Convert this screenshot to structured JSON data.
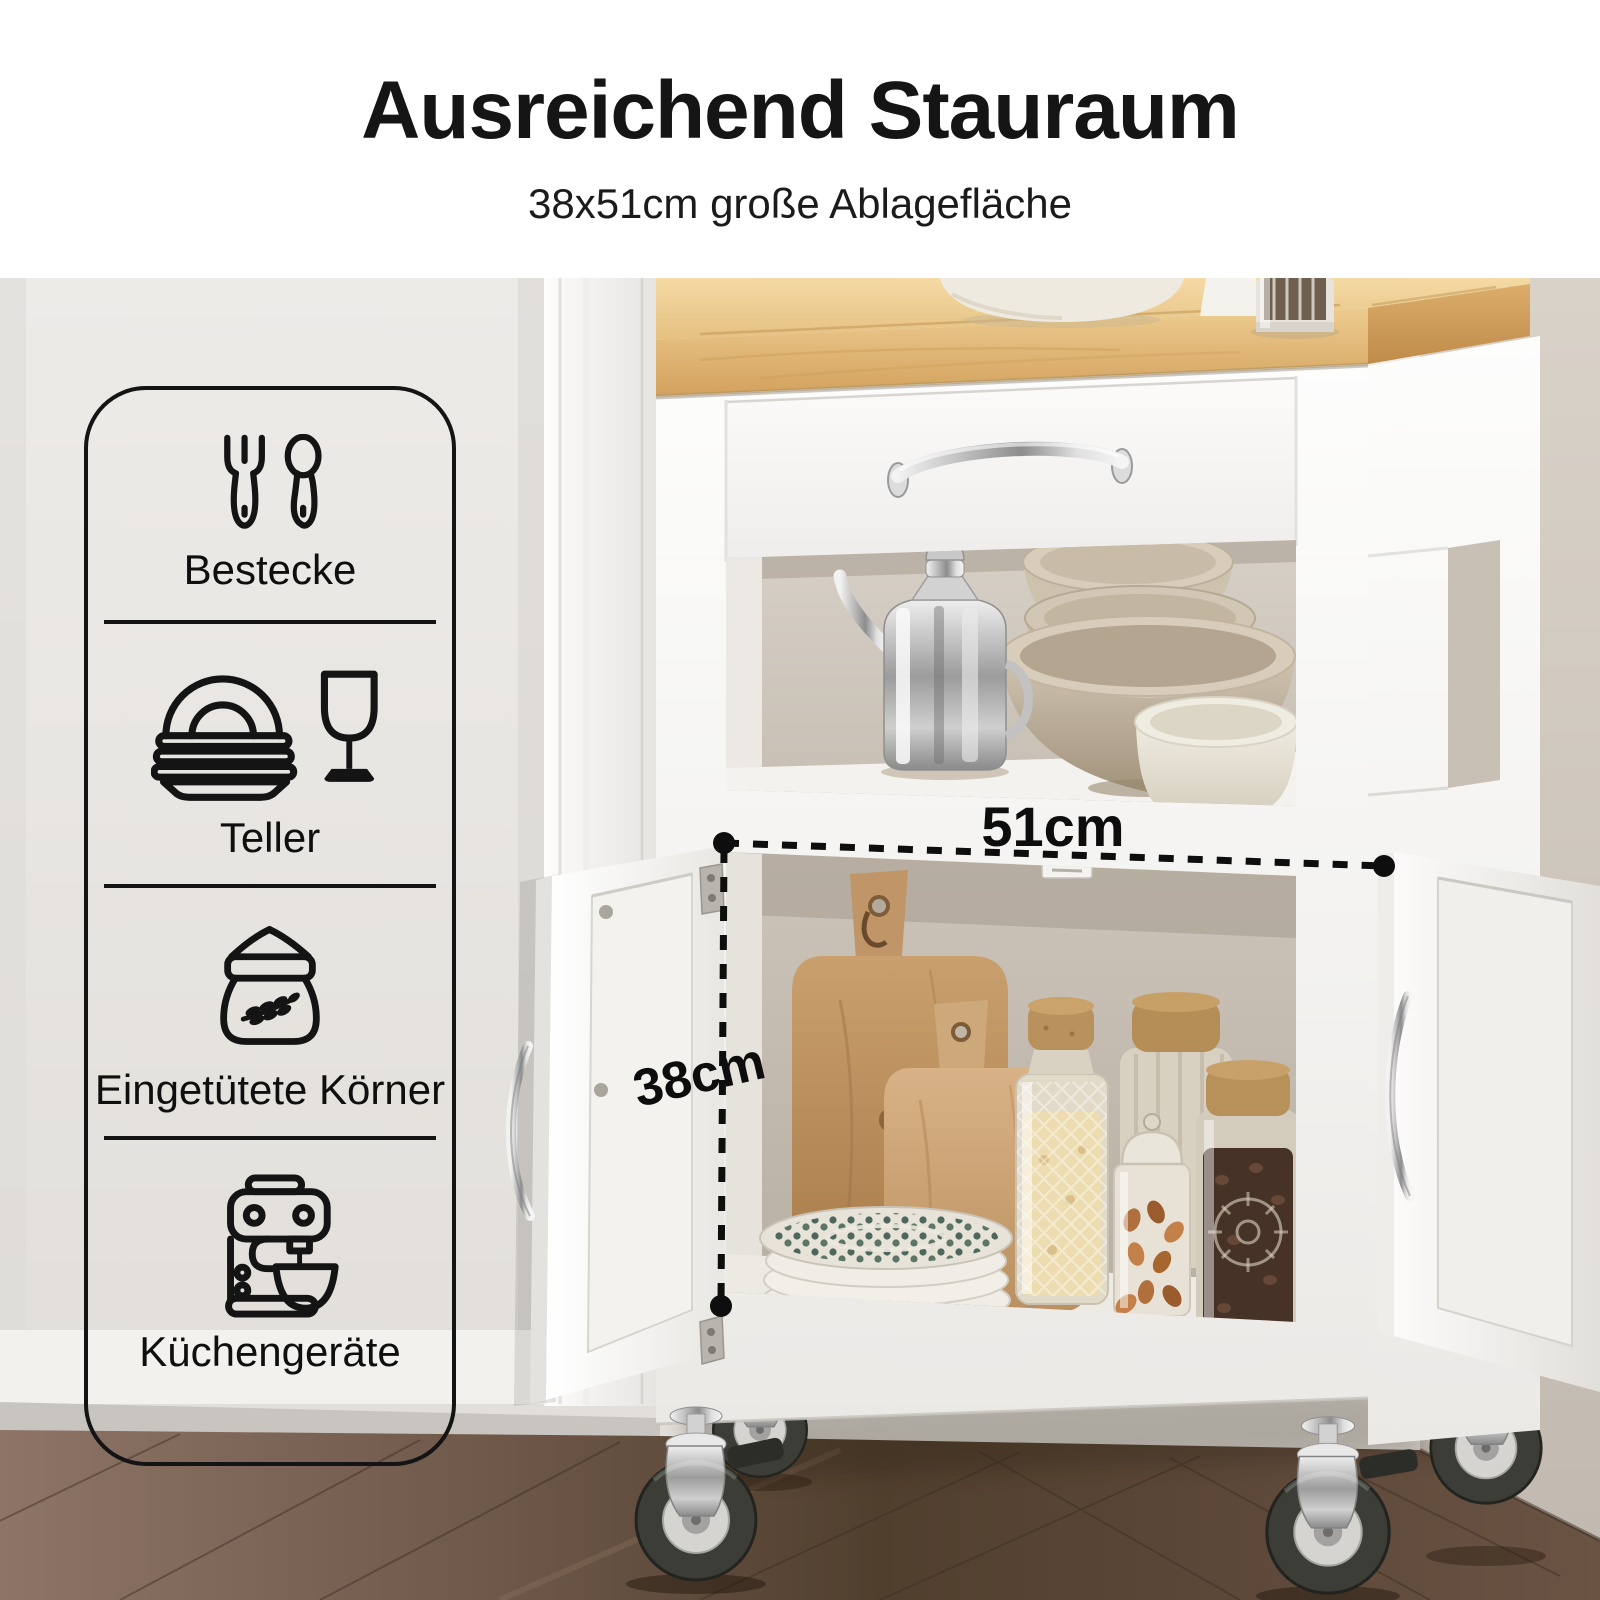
{
  "header": {
    "title": "Ausreichend Stauraum",
    "subtitle": "38x51cm große Ablagefläche"
  },
  "feature_panel": {
    "items": [
      {
        "icon": "cutlery-icon",
        "label": "Bestecke"
      },
      {
        "icon": "plates-wine-glass-icon",
        "label": "Teller"
      },
      {
        "icon": "grain-sack-icon",
        "label": "Eingetütete Körner"
      },
      {
        "icon": "stand-mixer-icon",
        "label": "Küchengeräte"
      }
    ]
  },
  "annotations": {
    "width_label": "51cm",
    "depth_label": "38cm"
  },
  "colors": {
    "annotation": "#111111",
    "wood_top": "#e7c285",
    "cart_white": "#f7f6f3",
    "wall_left": "#e9e7e4",
    "wall_right": "#cdc5ba",
    "floor_light": "#8a7163",
    "floor_dark": "#55402f"
  }
}
